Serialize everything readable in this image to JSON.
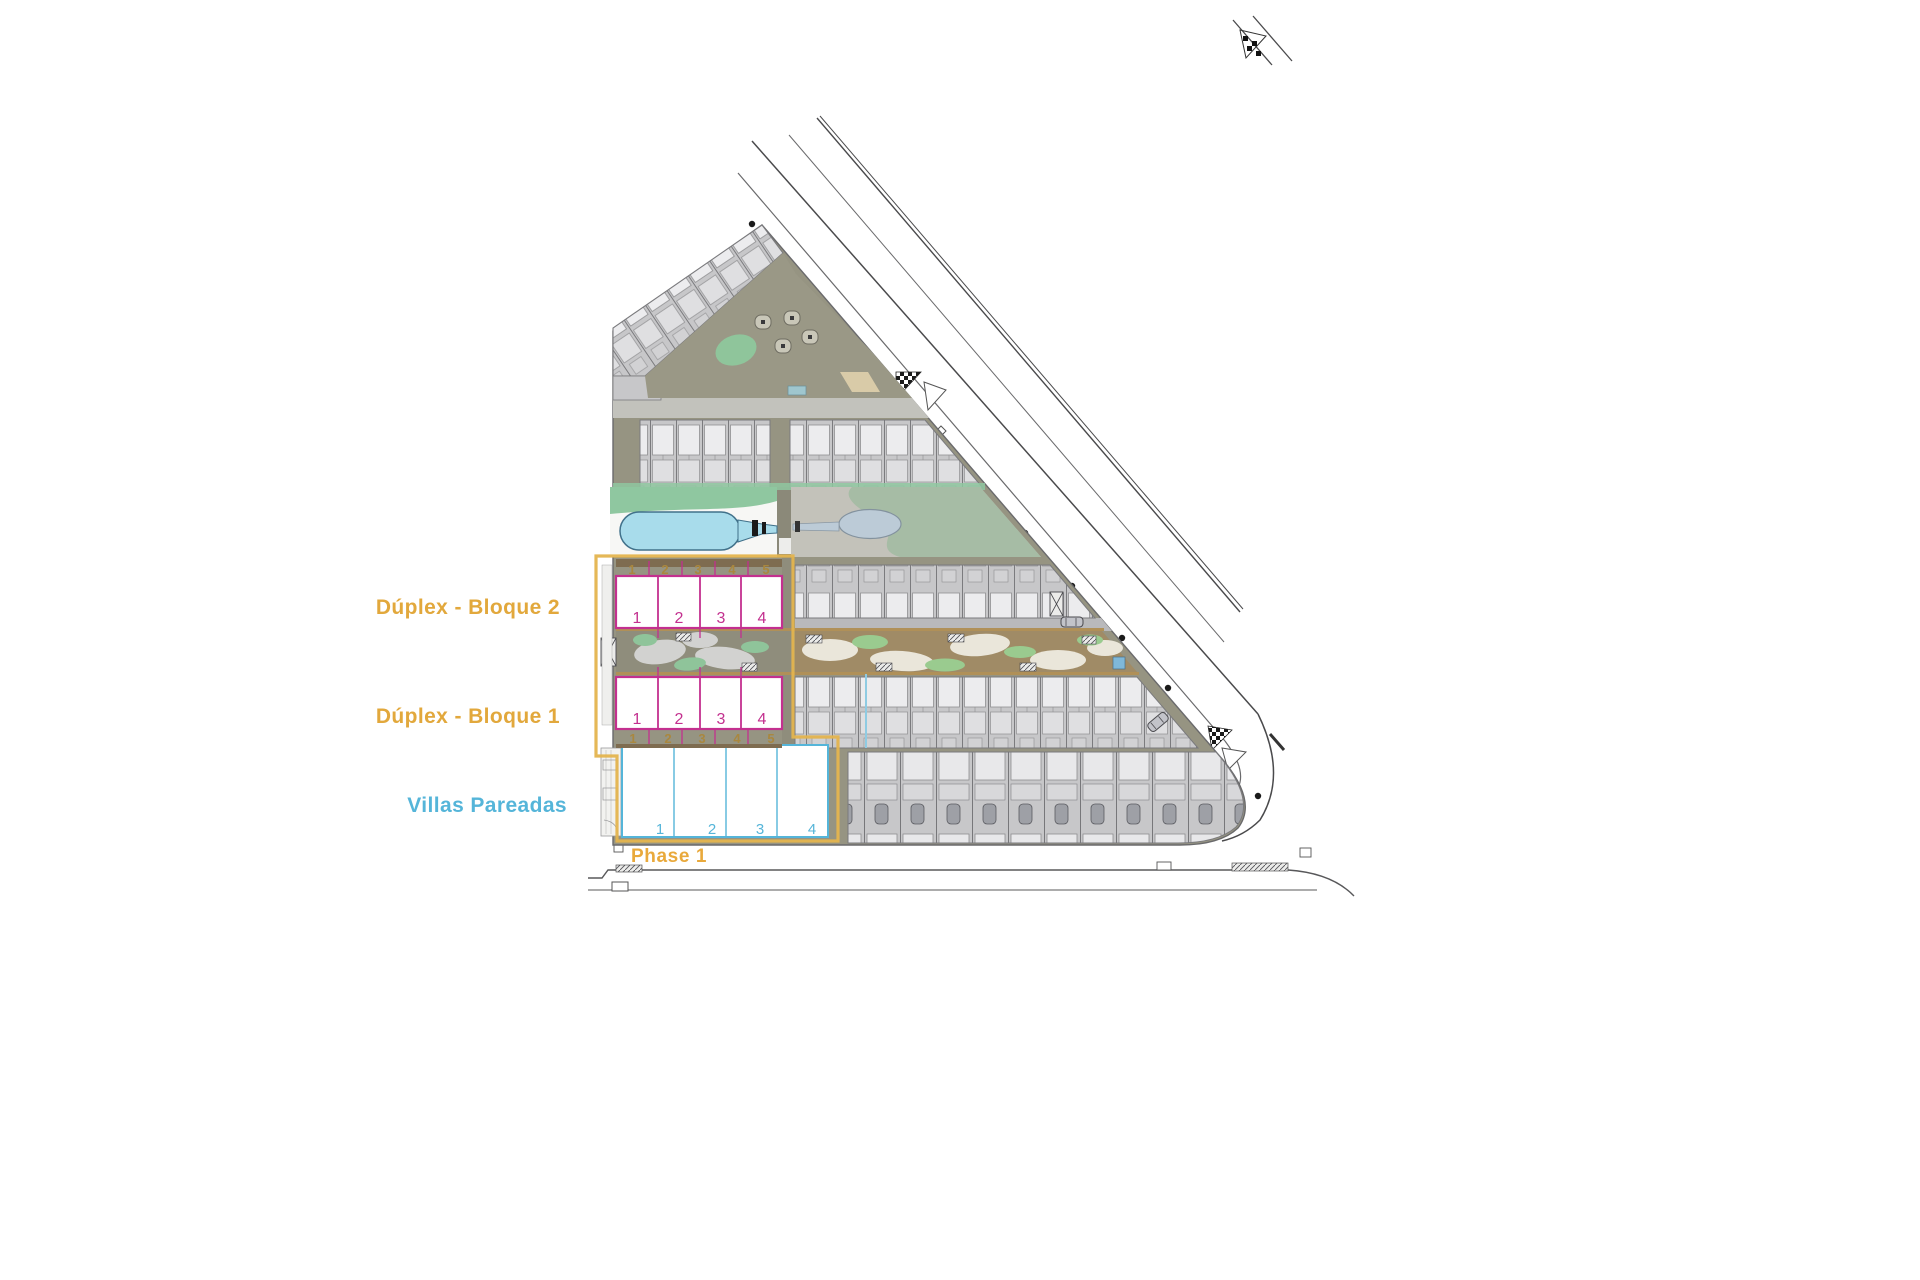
{
  "labels": {
    "bloque2": "Dúplex - Bloque 2",
    "bloque1": "Dúplex - Bloque 1",
    "villas": "Villas Pareadas",
    "phase1": "Phase 1"
  },
  "blocks": {
    "bloque2": {
      "parcel_numbers": [
        "1",
        "2",
        "3",
        "4",
        "5"
      ],
      "unit_numbers": [
        "1",
        "2",
        "3",
        "4"
      ]
    },
    "bloque1": {
      "unit_numbers": [
        "1",
        "2",
        "3",
        "4"
      ],
      "parcel_numbers": [
        "1",
        "2",
        "3",
        "4",
        "5"
      ]
    },
    "villas": {
      "unit_numbers": [
        "1",
        "2",
        "3",
        "4"
      ]
    }
  },
  "colors": {
    "label_orange": "#E2A83C",
    "phase_label_orange": "#E9A93B",
    "phase_boundary": "#E4B44E",
    "duplex_magenta": "#C3308F",
    "villas_cyan": "#55B5D9",
    "parcel_olive": "#A9873F",
    "pool_water": "#A8DCEB",
    "lawn_green": "#8FC7A0",
    "site_ground": "#969482",
    "building_grey": "#C7C7C9"
  }
}
